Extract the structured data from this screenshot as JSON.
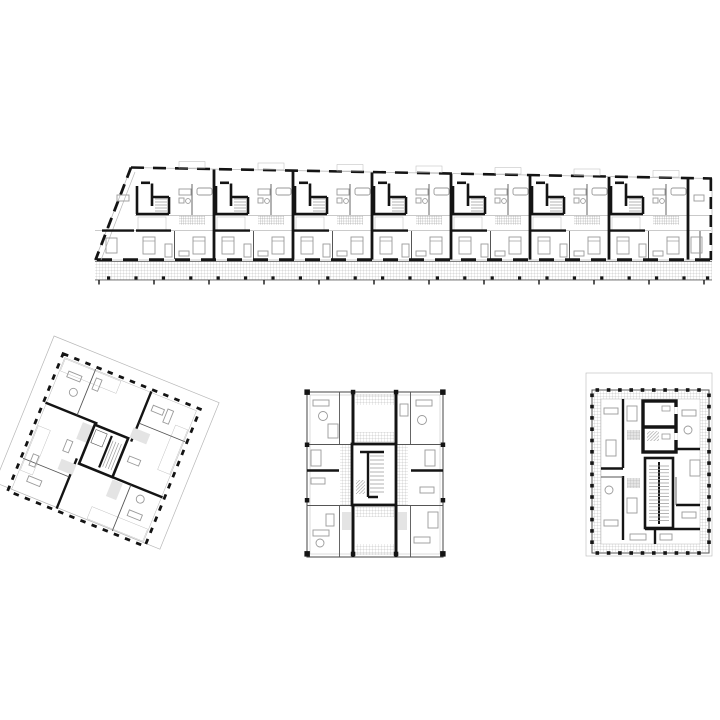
{
  "canvas": {
    "width": 720,
    "height": 720,
    "background": "#ffffff"
  },
  "colors": {
    "wall": "#141414",
    "partition": "#555555",
    "furniture": "#9a9a9a",
    "outline": "#b8b8b8",
    "hatch": "#a8a8a8",
    "hatch-dense": "#8a8a8a",
    "fill-light": "#e4e4e4",
    "paper": "#ffffff"
  },
  "plans": [
    {
      "id": "linear-block",
      "label": "Linear apartment slab floor plan with tapered west end and south gallery walkway",
      "position": "top",
      "modules": 7,
      "stair_cores": 7,
      "walkway_posts": 23,
      "tapered_end": "left"
    },
    {
      "id": "rotated-tower",
      "label": "Square point-tower floor plan rotated on site, central core, pinwheel balconies",
      "position": "bottom-left",
      "rotation_deg": 22
    },
    {
      "id": "tower-center",
      "label": "Point-tower floor plan with central stair core and twin entry halls",
      "position": "bottom-center"
    },
    {
      "id": "tower-right",
      "label": "Point-tower floor plan with perimeter balcony band and offset stair core",
      "position": "bottom-right"
    }
  ]
}
